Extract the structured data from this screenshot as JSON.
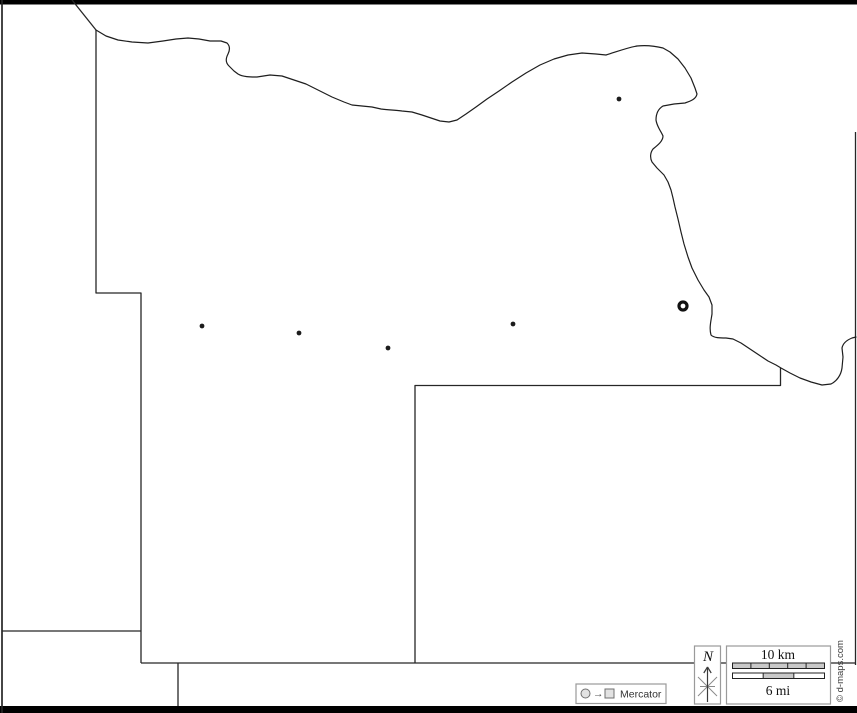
{
  "map": {
    "outline_color": "#262626",
    "background": "#ffffff",
    "cities": [
      {
        "x": 202,
        "y": 326
      },
      {
        "x": 299,
        "y": 333
      },
      {
        "x": 388,
        "y": 348
      },
      {
        "x": 513,
        "y": 324
      },
      {
        "x": 619,
        "y": 99
      }
    ],
    "county_seat": {
      "x": 683,
      "y": 306
    }
  },
  "projection_legend": {
    "label": "Mercator",
    "arrow_glyph": "→",
    "symbols": [
      "circle",
      "arrow-right",
      "square"
    ]
  },
  "north_indicator": {
    "label": "N"
  },
  "scale_bar": {
    "km_label": "10 km",
    "mi_label": "6 mi",
    "km_segments": 5,
    "mi_segments": 3,
    "bar_fill": "#c9c9c9"
  },
  "credit": {
    "text": "© d-maps.com"
  }
}
